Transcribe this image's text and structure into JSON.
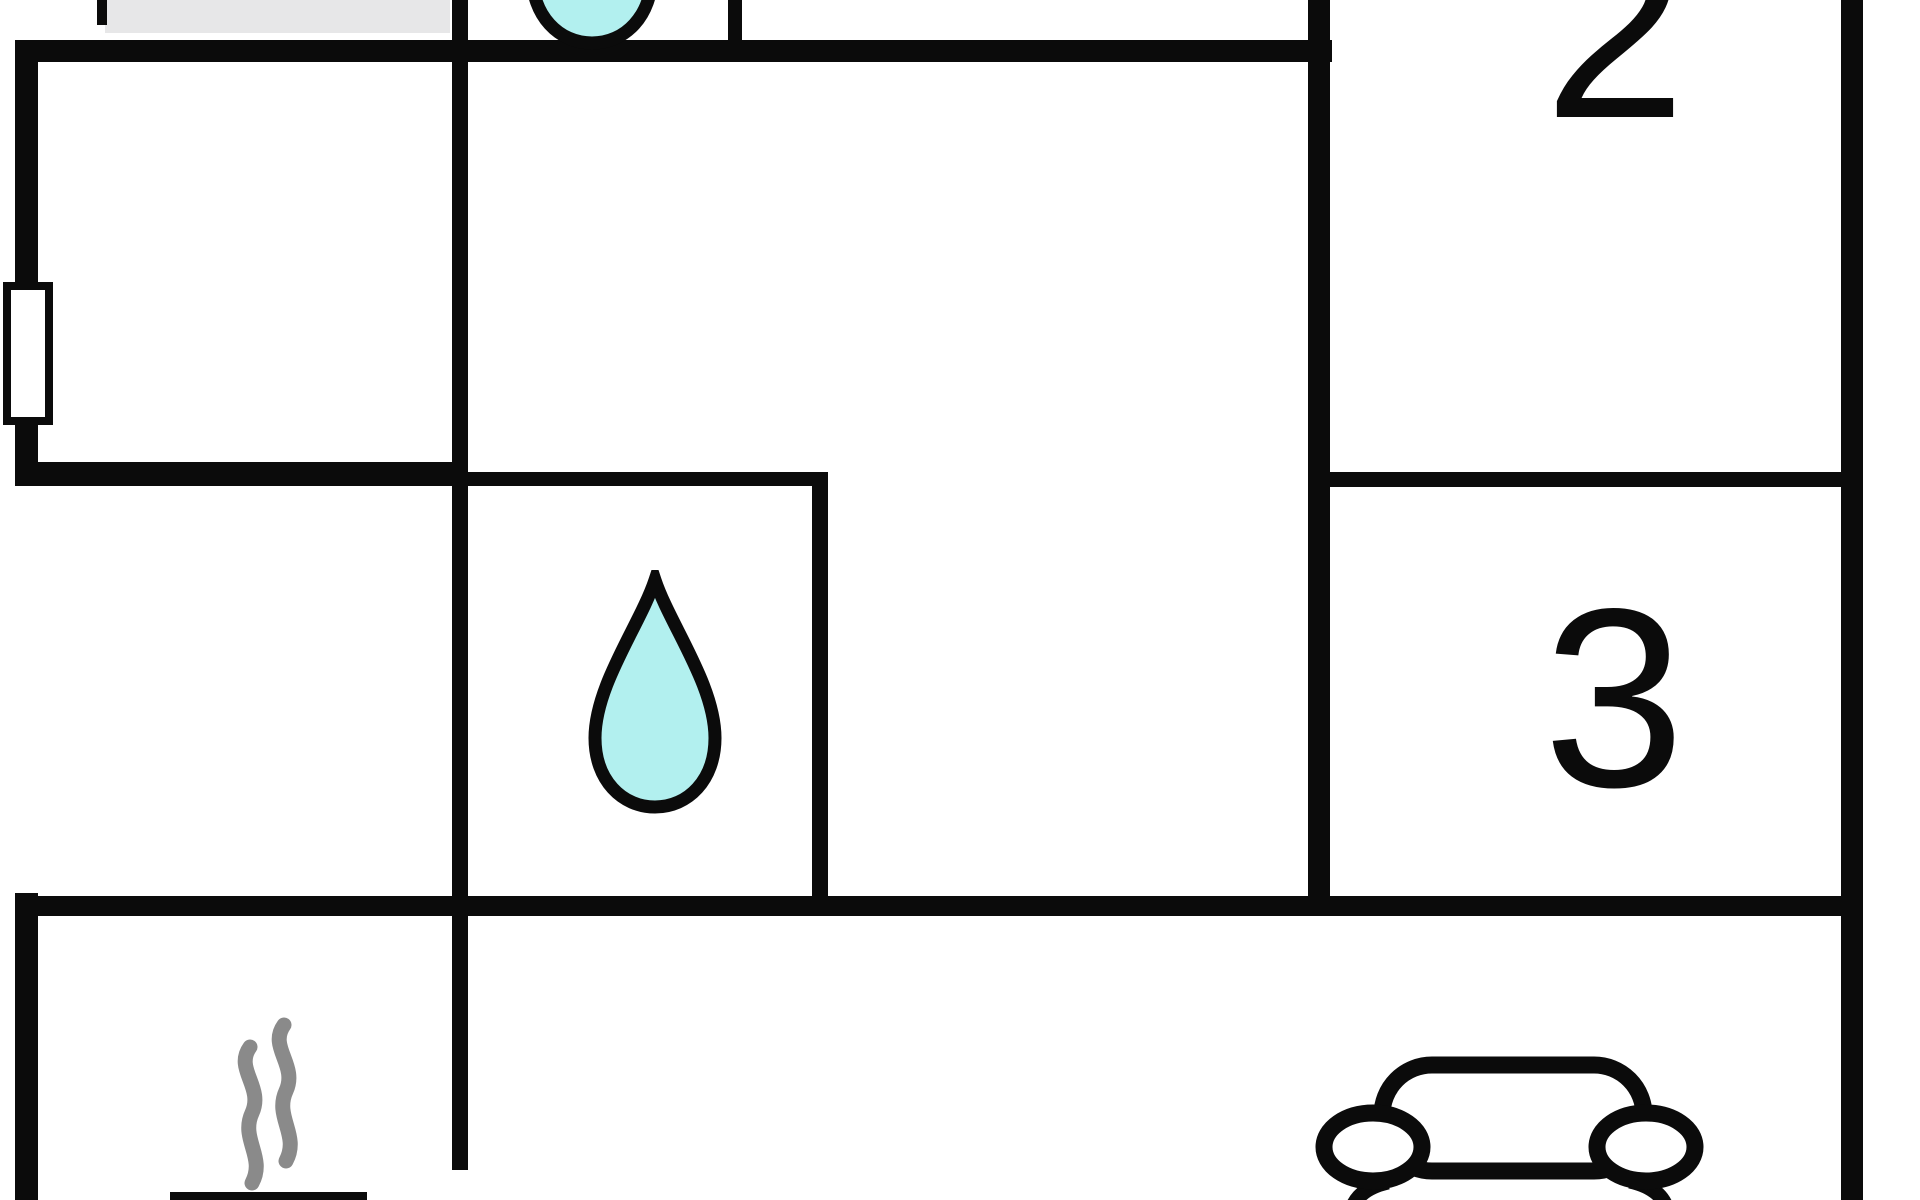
{
  "meta": {
    "type": "floor-plan",
    "description": "Holiday home floor plan, cropped at top and bottom edges"
  },
  "colors": {
    "background": "#ffffff",
    "wall": "#0b0b0b",
    "furniture_gray": "#e7e7e8",
    "water_drop_fill": "#b2f0ef",
    "water_drop_outline": "#0b0b0b",
    "steam_gray": "#8a8a8a",
    "car_outline": "#0b0b0b"
  },
  "rooms": {
    "room2": {
      "label": "2"
    },
    "room3": {
      "label": "3"
    }
  },
  "icons": {
    "water_drop_top": "water-drop-icon",
    "water_drop_bathroom": "water-drop-icon",
    "steam": "steam-icon",
    "car": "car-icon",
    "window": "window-marker",
    "furniture": "gray-furniture-block",
    "bench": "bench-bar"
  }
}
